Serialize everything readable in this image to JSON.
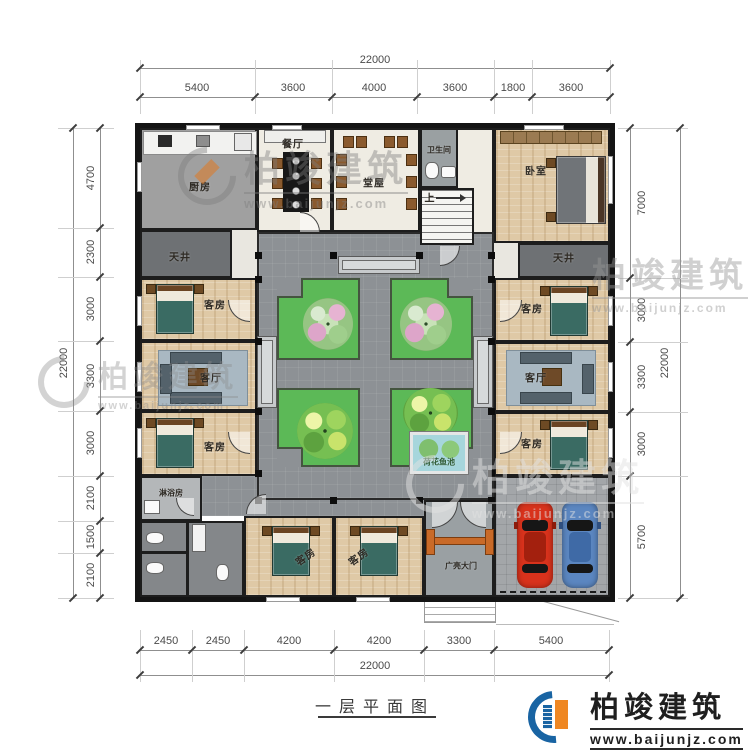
{
  "caption": "一层平面图",
  "dims": {
    "top": {
      "overall": "22000",
      "segs": [
        "5400",
        "3600",
        "4000",
        "3600",
        "1800",
        "3600"
      ]
    },
    "left": {
      "overall": "22000",
      "segs": [
        "4700",
        "2300",
        "3000",
        "3300",
        "3000",
        "2100",
        "1500",
        "2100"
      ]
    },
    "right": {
      "overall": "22000",
      "segs": [
        "7000",
        "3000",
        "3300",
        "3000",
        "5700"
      ]
    },
    "bottom": {
      "overall": "22000",
      "segs": [
        "2450",
        "2450",
        "4200",
        "4200",
        "3300",
        "5400"
      ]
    }
  },
  "rooms": {
    "kitchen": "厨房",
    "dining": "餐厅",
    "hall": "堂屋",
    "bathroom": "卫生间",
    "stairs_up": "上",
    "bedroom": "卧室",
    "skywell": "天井",
    "guest": "客房",
    "living": "客厅",
    "shower": "淋浴房",
    "gate": "广亮大门",
    "pond": "荷花鱼池"
  },
  "watermark": {
    "brand": "柏竣建筑",
    "url": "www.baijunjz.com"
  },
  "logo": {
    "brand": "柏竣建筑",
    "url": "www.baijunjz.com"
  },
  "colors": {
    "accent_blue": "#1964a3",
    "accent_orange": "#ef8722",
    "lawn_green": "#5cb957",
    "pond_blue": "#a6d6dc",
    "car_red": "#d8321c",
    "car_blue": "#5b86c0"
  }
}
